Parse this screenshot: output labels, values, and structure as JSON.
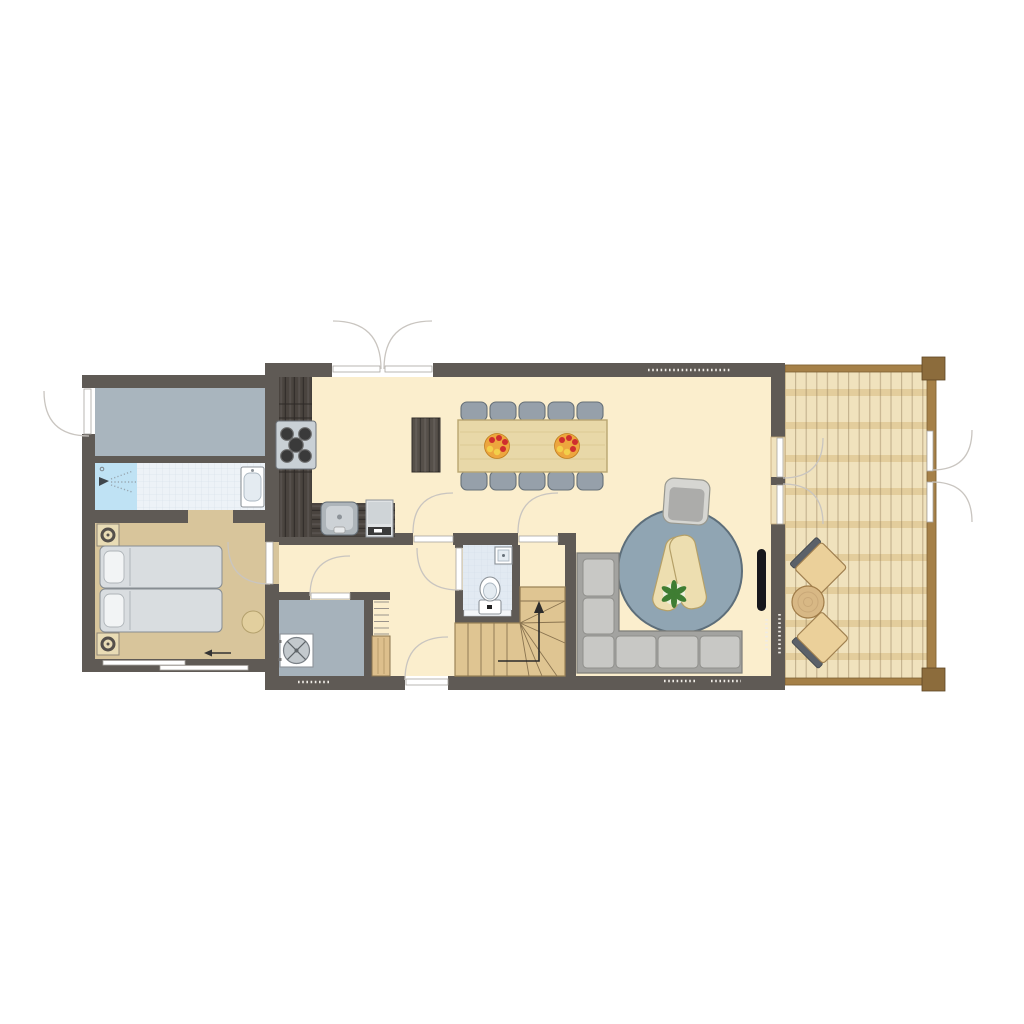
{
  "palette": {
    "background": "#ffffff",
    "wall": "#5f5a55",
    "floor_main": "#fbeecd",
    "floor_bedroom": "#d8c59b",
    "floor_storage": "#a9b5be",
    "floor_utility": "#a6b2bb",
    "floor_bath": "#edf2f7",
    "shower": "#bfe2f4",
    "floor_toilet": "#e2eaf2",
    "counter_wood": "#4a443f",
    "appliance_gray": "#c9d0d5",
    "burner_dark": "#3a3a3a",
    "table_wood": "#e8d8a8",
    "wood_border": "#b9a671",
    "chair_gray": "#96a0aa",
    "chair_border": "#667078",
    "sofa_frame": "#a3a3a0",
    "sofa_cushion": "#c8c8c5",
    "rug_blue": "#90a5b3",
    "rug_border": "#5d6e7a",
    "armchair_gray": "#acacaa",
    "armchair_light": "#d6d6d2",
    "coffee_table_wood": "#eddeb0",
    "plant_green": "#3f7d33",
    "deck_floor": "#f0e2bd",
    "deck_joist": "#e3cd9c",
    "deck_line": "#8a7450",
    "deck_frame": "#a58048",
    "deck_post": "#8c6c3c",
    "outdoor_wood": "#ebd09a",
    "outdoor_back": "#5b6169",
    "outdoor_table": "#d8b885",
    "bed_mattress": "#d9dde0",
    "bed_pillow": "#f2f4f5",
    "pouf": "#e2cf9e",
    "stair_wood": "#dfc592",
    "stair_line": "#8a7450",
    "door_leaf": "#ffffff",
    "door_arc": "#c9c5c0",
    "white_fixture": "#ffffff",
    "fixture_border": "#8d9399",
    "tv_black": "#17171c",
    "fruit_orange": "#eda63e",
    "fruit_red": "#cf2e2e",
    "fruit_yellow": "#f3cf4a"
  },
  "floor_plan": {
    "type": "top-down architectural floor plan",
    "rooms": [
      {
        "id": "entrance-storage-room",
        "floor_color": "floor_storage",
        "items": [
          "entry-door"
        ]
      },
      {
        "id": "bathroom",
        "floor_color": "floor_bath",
        "items": [
          "shower",
          "washbasin"
        ]
      },
      {
        "id": "bedroom",
        "floor_color": "floor_bedroom",
        "items": [
          "double-bed",
          "two-pillows",
          "bedside-table",
          "bedside-table",
          "pouf",
          "sliding-door",
          "direction-arrow"
        ]
      },
      {
        "id": "kitchen",
        "floor_color": "floor_main",
        "items": [
          "l-shaped-counter",
          "gas-hob-5-burners",
          "kitchen-sink",
          "coffee-machine"
        ]
      },
      {
        "id": "dining-area",
        "floor_color": "floor_main",
        "items": [
          "sideboard",
          "dining-table",
          "ten-chairs",
          "two-fruit-bowls"
        ]
      },
      {
        "id": "living-area",
        "floor_color": "floor_main",
        "items": [
          "round-rug",
          "armchair",
          "two-coffee-tables",
          "plant",
          "corner-sofa",
          "wall-mounted-tv"
        ]
      },
      {
        "id": "hallway",
        "floor_color": "floor_main",
        "items": [
          "shelving-closet",
          "wooden-cabinet",
          "front-door"
        ]
      },
      {
        "id": "utility-room",
        "floor_color": "floor_utility",
        "items": [
          "washing-machine"
        ]
      },
      {
        "id": "wc",
        "floor_color": "floor_toilet",
        "items": [
          "toilet",
          "corner-basin"
        ]
      },
      {
        "id": "staircase",
        "floor_color": "stair_wood",
        "items": [
          "winder-stairs",
          "up-arrow"
        ]
      },
      {
        "id": "terrace-deck",
        "floor_color": "deck_floor",
        "items": [
          "deck-chair",
          "deck-chair",
          "round-side-table",
          "double-gate",
          "double-doors"
        ]
      }
    ],
    "doors": {
      "single_hinged": 7,
      "double_french": 3,
      "sliding": 1
    },
    "vents": 5
  }
}
